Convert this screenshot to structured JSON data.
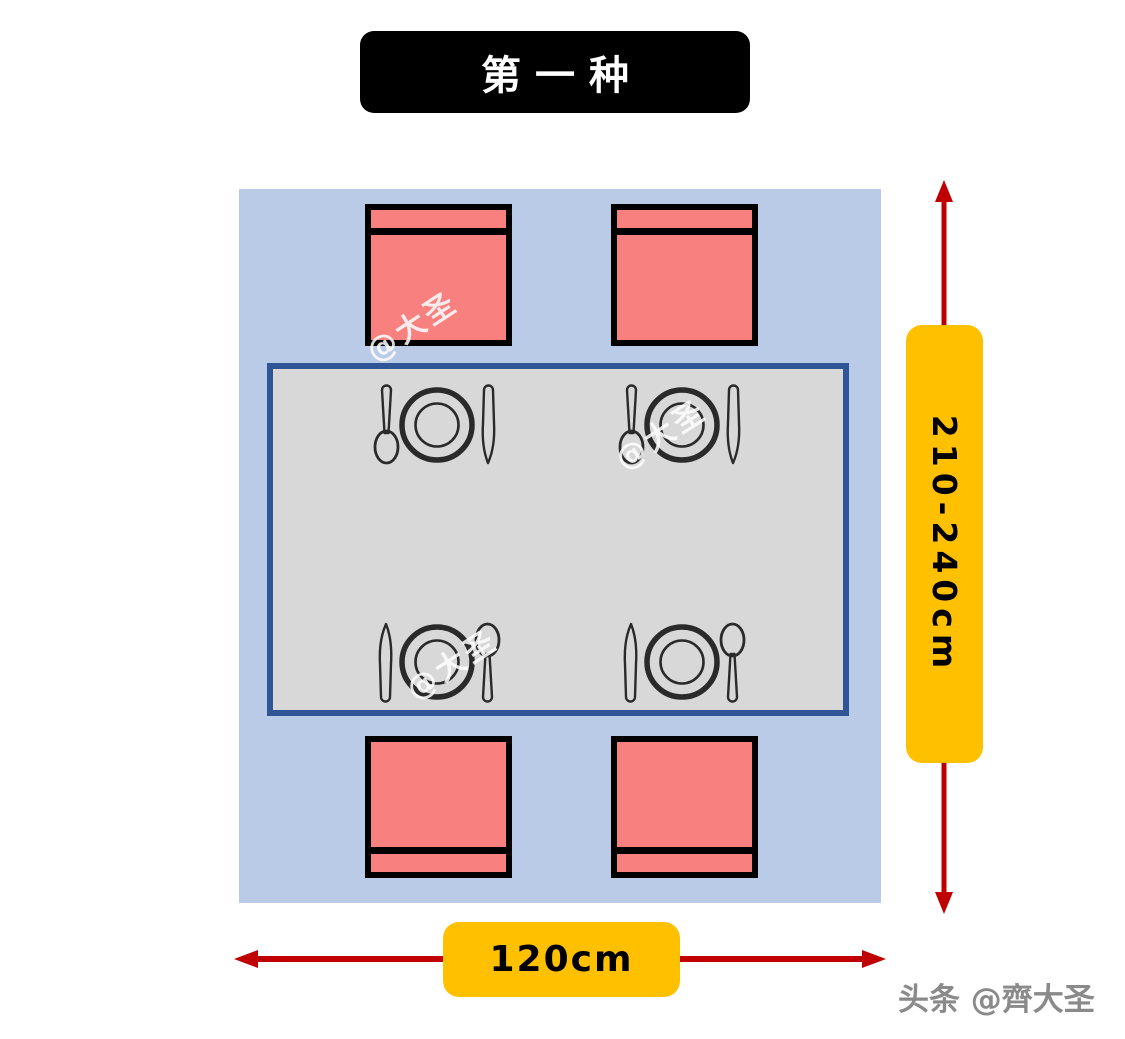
{
  "title": {
    "label": "第一种"
  },
  "scene": {
    "type": "dining-table-floor-plan",
    "chairs_count": 4,
    "place_settings_count": 4
  },
  "dimensions": {
    "height": {
      "label": "210-240cm"
    },
    "width": {
      "label": "120cm"
    }
  },
  "watermark": {
    "text": "@大圣"
  },
  "credit": {
    "text": "头条 @齊大圣"
  },
  "colors": {
    "room_bg": "#B9CBE6",
    "table_fill": "#D8D8D8",
    "table_border": "#2F5597",
    "chair_fill": "#F8807E",
    "chair_border": "#000000",
    "arrow_color": "#C00000",
    "dim_label_bg": "#FFC000",
    "title_bg": "#000000",
    "title_text": "#FFFFFF"
  }
}
